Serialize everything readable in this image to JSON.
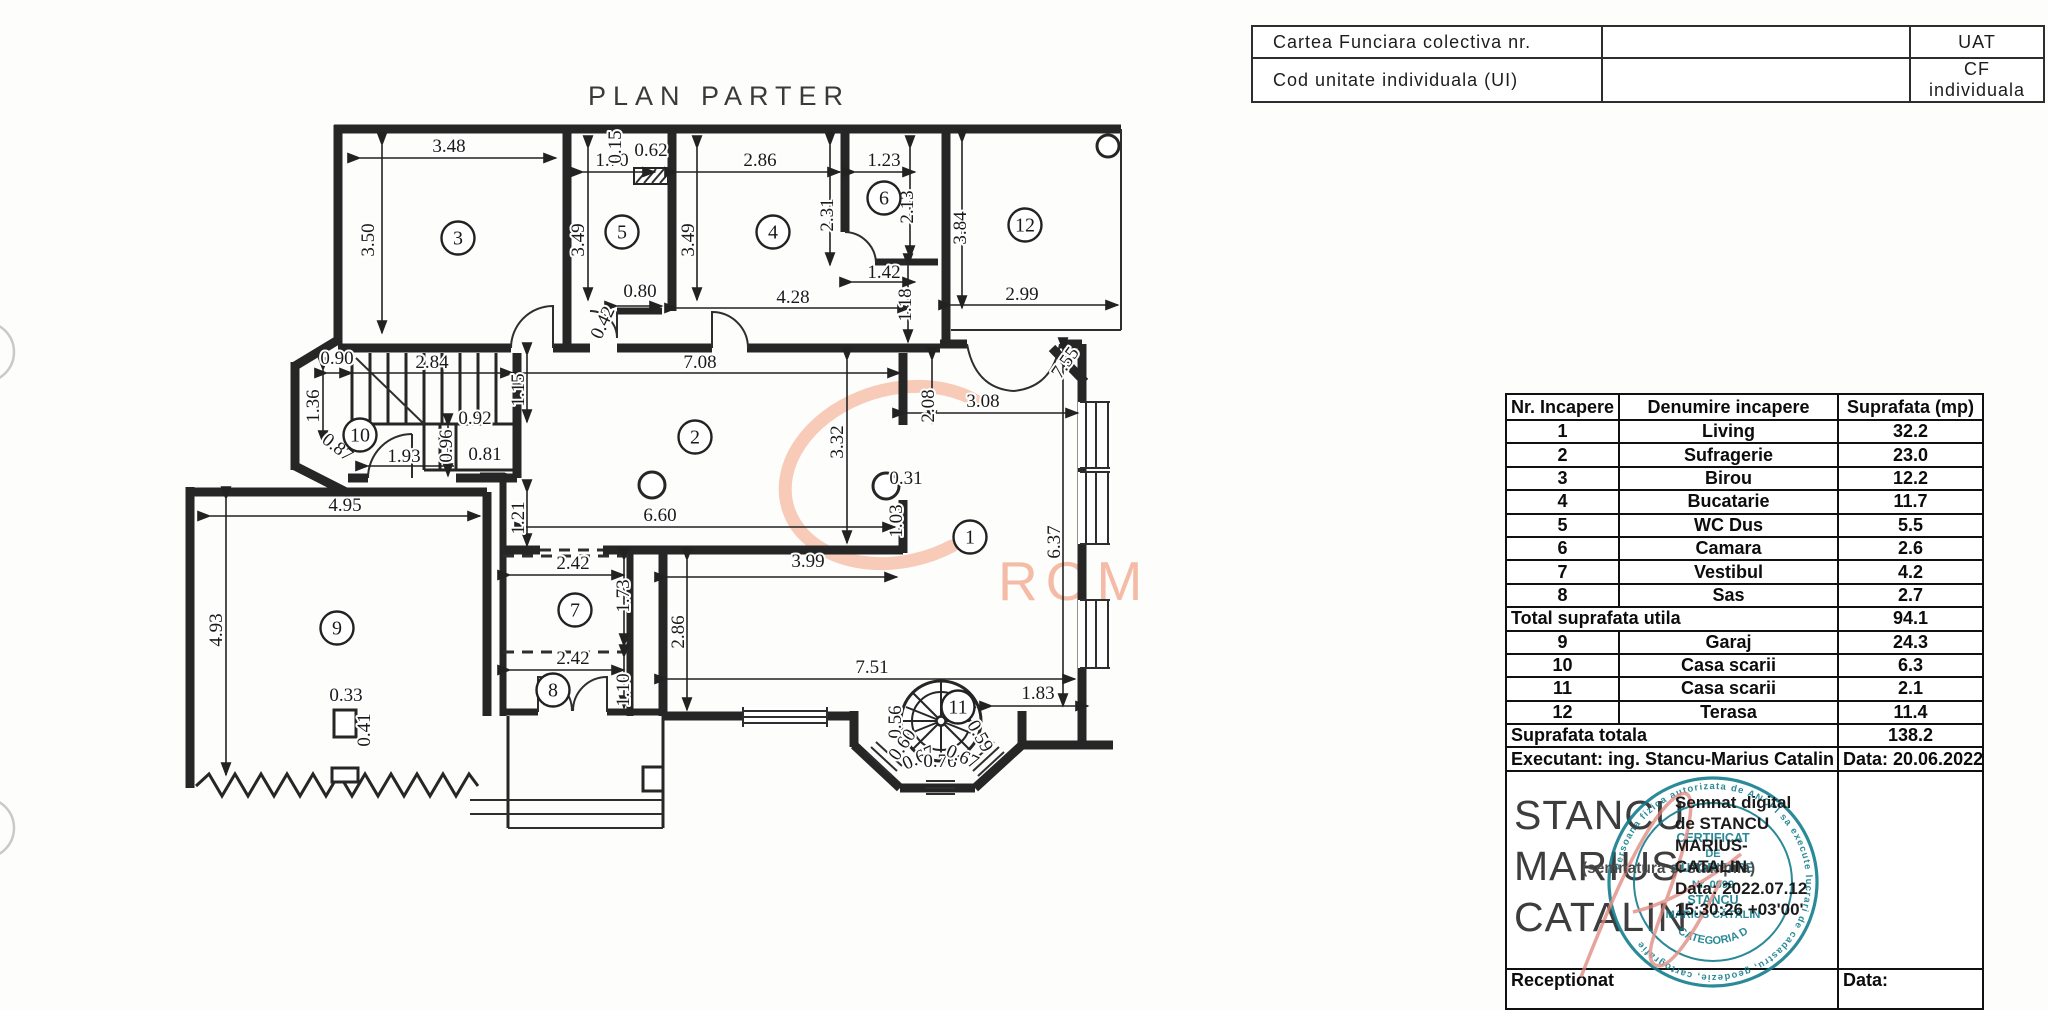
{
  "header_table": {
    "rows": [
      {
        "label": "Cartea  Funciara  colectiva  nr.",
        "value": "",
        "right": "UAT"
      },
      {
        "label": "Cod  unitate  individuala  (UI)",
        "value": "",
        "right": "CF  individuala"
      }
    ]
  },
  "plan": {
    "title": "PLAN  PARTER",
    "watermark": "ROMANIA",
    "watermark_color": "#f4bca6",
    "line_color": "#262626",
    "room_circles": [
      {
        "n": "1",
        "x": 970,
        "y": 537
      },
      {
        "n": "2",
        "x": 695,
        "y": 437
      },
      {
        "n": "3",
        "x": 458,
        "y": 238
      },
      {
        "n": "4",
        "x": 773,
        "y": 232
      },
      {
        "n": "5",
        "x": 622,
        "y": 232
      },
      {
        "n": "6",
        "x": 884,
        "y": 198
      },
      {
        "n": "7",
        "x": 575,
        "y": 610
      },
      {
        "n": "8",
        "x": 553,
        "y": 690
      },
      {
        "n": "9",
        "x": 337,
        "y": 628
      },
      {
        "n": "10",
        "x": 360,
        "y": 435
      },
      {
        "n": "11",
        "x": 958,
        "y": 707
      },
      {
        "n": "12",
        "x": 1025,
        "y": 225
      }
    ],
    "dim_labels": [
      {
        "t": "3.48",
        "x": 449,
        "y": 152
      },
      {
        "t": "3.50",
        "x": 374,
        "y": 240,
        "r": -90
      },
      {
        "t": "1.70",
        "x": 612,
        "y": 166
      },
      {
        "t": "0.15",
        "x": 621,
        "y": 147,
        "r": -90
      },
      {
        "t": "0.62",
        "x": 651,
        "y": 156
      },
      {
        "t": "3.49",
        "x": 584,
        "y": 240,
        "r": -90
      },
      {
        "t": "0.80",
        "x": 640,
        "y": 297
      },
      {
        "t": "0.42",
        "x": 608,
        "y": 325,
        "r": -65
      },
      {
        "t": "2.86",
        "x": 760,
        "y": 166
      },
      {
        "t": "3.49",
        "x": 694,
        "y": 240,
        "r": -90
      },
      {
        "t": "2.31",
        "x": 833,
        "y": 215,
        "r": -90
      },
      {
        "t": "4.28",
        "x": 793,
        "y": 303
      },
      {
        "t": "1.23",
        "x": 884,
        "y": 166
      },
      {
        "t": "2.13",
        "x": 913,
        "y": 207,
        "r": -90
      },
      {
        "t": "1.42",
        "x": 884,
        "y": 278
      },
      {
        "t": "1.18",
        "x": 911,
        "y": 305,
        "r": -90
      },
      {
        "t": "3.84",
        "x": 966,
        "y": 228,
        "r": -90
      },
      {
        "t": "2.99",
        "x": 1022,
        "y": 300
      },
      {
        "t": "7.55",
        "x": 1070,
        "y": 366,
        "r": -55
      },
      {
        "t": "7.08",
        "x": 700,
        "y": 368
      },
      {
        "t": "2.84",
        "x": 432,
        "y": 368
      },
      {
        "t": "0.90",
        "x": 337,
        "y": 364
      },
      {
        "t": "1.15",
        "x": 524,
        "y": 390,
        "r": -90
      },
      {
        "t": "1.36",
        "x": 319,
        "y": 406,
        "r": -90
      },
      {
        "t": "0.87",
        "x": 334,
        "y": 452,
        "r": 38
      },
      {
        "t": "0.92",
        "x": 475,
        "y": 424
      },
      {
        "t": "0.96",
        "x": 452,
        "y": 446,
        "r": -90
      },
      {
        "t": "0.81",
        "x": 485,
        "y": 460
      },
      {
        "t": "1.93",
        "x": 404,
        "y": 462
      },
      {
        "t": "1.21",
        "x": 524,
        "y": 518,
        "r": -90
      },
      {
        "t": "6.60",
        "x": 660,
        "y": 521
      },
      {
        "t": "3.32",
        "x": 843,
        "y": 442,
        "r": -90
      },
      {
        "t": "2.08",
        "x": 934,
        "y": 406,
        "r": -90
      },
      {
        "t": "3.08",
        "x": 983,
        "y": 407
      },
      {
        "t": "0.31",
        "x": 906,
        "y": 484
      },
      {
        "t": "1.03",
        "x": 902,
        "y": 521,
        "r": -90
      },
      {
        "t": "6.37",
        "x": 1060,
        "y": 542,
        "r": -90
      },
      {
        "t": "4.95",
        "x": 345,
        "y": 511
      },
      {
        "t": "4.93",
        "x": 222,
        "y": 630,
        "r": -90
      },
      {
        "t": "0.33",
        "x": 346,
        "y": 701
      },
      {
        "t": "0.41",
        "x": 370,
        "y": 730,
        "r": -90
      },
      {
        "t": "2.42",
        "x": 573,
        "y": 569
      },
      {
        "t": "1.73",
        "x": 629,
        "y": 596,
        "r": -90
      },
      {
        "t": "2.42",
        "x": 573,
        "y": 664
      },
      {
        "t": "1.10",
        "x": 629,
        "y": 690,
        "r": -90
      },
      {
        "t": "2.86",
        "x": 684,
        "y": 632,
        "r": -90
      },
      {
        "t": "3.99",
        "x": 808,
        "y": 567
      },
      {
        "t": "7.51",
        "x": 872,
        "y": 673
      },
      {
        "t": "1.83",
        "x": 1038,
        "y": 699
      },
      {
        "t": "0.56",
        "x": 901,
        "y": 722,
        "r": -90
      },
      {
        "t": "0.60",
        "x": 907,
        "y": 748,
        "r": -55
      },
      {
        "t": "0.67",
        "x": 921,
        "y": 763,
        "r": -25
      },
      {
        "t": "0.76",
        "x": 940,
        "y": 767
      },
      {
        "t": "0.67",
        "x": 960,
        "y": 762,
        "r": 25
      },
      {
        "t": "0.59",
        "x": 975,
        "y": 739,
        "r": 60
      }
    ]
  },
  "rooms_table": {
    "headers": [
      "Nr. Incapere",
      "Denumire incapere",
      "Suprafata (mp)"
    ],
    "rows": [
      [
        "1",
        "Living",
        "32.2"
      ],
      [
        "2",
        "Sufragerie",
        "23.0"
      ],
      [
        "3",
        "Birou",
        "12.2"
      ],
      [
        "4",
        "Bucatarie",
        "11.7"
      ],
      [
        "5",
        "WC Dus",
        "5.5"
      ],
      [
        "6",
        "Camara",
        "2.6"
      ],
      [
        "7",
        "Vestibul",
        "4.2"
      ],
      [
        "8",
        "Sas",
        "2.7"
      ]
    ],
    "total_utila": {
      "label": "Total suprafata utila",
      "value": "94.1"
    },
    "rows2": [
      [
        "9",
        "Garaj",
        "24.3"
      ],
      [
        "10",
        "Casa scarii",
        "6.3"
      ],
      [
        "11",
        "Casa scarii",
        "2.1"
      ],
      [
        "12",
        "Terasa",
        "11.4"
      ]
    ],
    "total": {
      "label": "Suprafata totala",
      "value": "138.2"
    },
    "executant": {
      "label": "Executant: ing. Stancu-Marius Catalin",
      "date": "Data: 20.06.2022"
    },
    "signature": {
      "name_lines": [
        "STANCU",
        "MARIUS",
        "CATALIN"
      ],
      "digital_lines": [
        "Semnat digital",
        "de STANCU",
        "MARIUS-",
        "CATALIN",
        "Data: 2022.07.12",
        "15:30:26 +03'00'"
      ],
      "stamp_note": "(semnatura si stampila)",
      "stamp": {
        "color": "#0d7a8a",
        "ring": "Persoana fizica autorizata de ANCPI sa execute lucrari de cadastru, geodezie, cartografie",
        "line1": "CERTIFICAT",
        "line2": "DE",
        "line3": "AUTORIZARE",
        "line4": "Nr. 0099",
        "line5": "STANCU",
        "line6": "MARIUS CĂTĂLIN",
        "bottom": "CATEGORIA D"
      }
    },
    "receptionat": {
      "label": "Receptionat",
      "date_label": "Data:"
    }
  }
}
